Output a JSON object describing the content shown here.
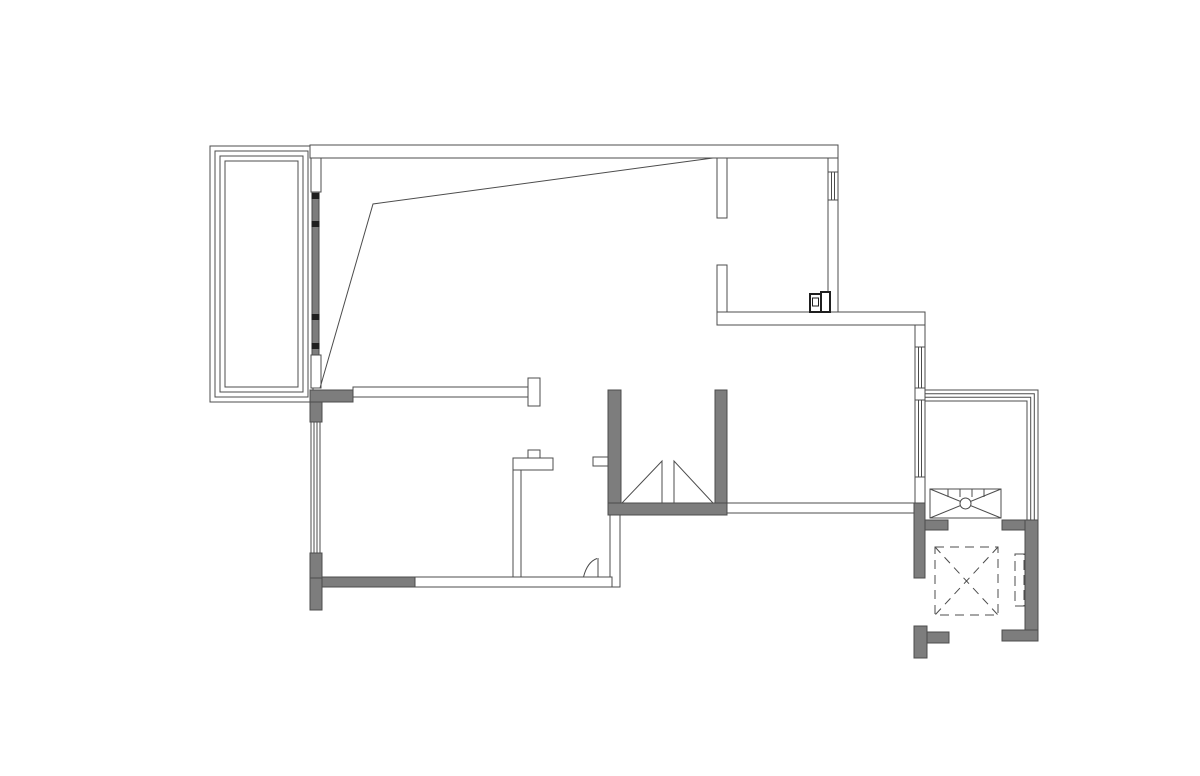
{
  "canvas": {
    "width": 1200,
    "height": 776,
    "background": "#ffffff"
  },
  "palette": {
    "line": "#4c4c4c",
    "wall": "#7d7d7d",
    "mark": "#1f1f1f",
    "white": "#ffffff"
  },
  "floorplan": {
    "description": "apartment-floor-plan-cad-drawing",
    "shapes": [
      {
        "t": "rect",
        "name": "balcony-left-rail-outer",
        "x": 210,
        "y": 146,
        "w": 103,
        "h": 256
      },
      {
        "t": "rect",
        "name": "balcony-left-rail-2",
        "x": 215,
        "y": 151,
        "w": 93,
        "h": 246
      },
      {
        "t": "rect",
        "name": "balcony-left-rail-3",
        "x": 220,
        "y": 156,
        "w": 83,
        "h": 236
      },
      {
        "t": "rect",
        "name": "balcony-left-rail-inner",
        "x": 225,
        "y": 161,
        "w": 73,
        "h": 226
      },
      {
        "t": "rect",
        "name": "wall-top",
        "x": 310,
        "y": 145,
        "w": 528,
        "h": 13,
        "f": "white"
      },
      {
        "t": "rect",
        "name": "wall-balcony-jamb-top",
        "x": 311,
        "y": 158,
        "w": 10,
        "h": 34,
        "f": "white"
      },
      {
        "t": "rect",
        "name": "wall-balcony-jamb-bottom",
        "x": 311,
        "y": 355,
        "w": 10,
        "h": 33,
        "f": "white"
      },
      {
        "t": "rect",
        "name": "wall-east-upper",
        "x": 828,
        "y": 158,
        "w": 10,
        "h": 154,
        "f": "white"
      },
      {
        "t": "rect",
        "name": "window-east-upper",
        "x": 828,
        "y": 172,
        "w": 10,
        "h": 28,
        "f": "white"
      },
      {
        "t": "line",
        "name": "window-east-upper-mullion-1",
        "x1": 831.3,
        "y1": 172,
        "x2": 831.3,
        "y2": 200
      },
      {
        "t": "line",
        "name": "window-east-upper-mullion-2",
        "x1": 834.6,
        "y1": 172,
        "x2": 834.6,
        "y2": 200
      },
      {
        "t": "rect",
        "name": "wall-stub-upper-1",
        "x": 717,
        "y": 158,
        "w": 10,
        "h": 60,
        "f": "white"
      },
      {
        "t": "rect",
        "name": "wall-stub-upper-2",
        "x": 717,
        "y": 265,
        "w": 10,
        "h": 47,
        "f": "white"
      },
      {
        "t": "rect",
        "name": "wall-mid-horizontal",
        "x": 717,
        "y": 312,
        "w": 208,
        "h": 13,
        "f": "white"
      },
      {
        "t": "rect",
        "name": "wall-east-mid-1",
        "x": 915,
        "y": 325,
        "w": 10,
        "h": 22,
        "f": "white"
      },
      {
        "t": "rect",
        "name": "window-east-1",
        "x": 915,
        "y": 347,
        "w": 10,
        "h": 41,
        "f": "white"
      },
      {
        "t": "line",
        "name": "window-east-1-mullion-1",
        "x1": 918.3,
        "y1": 347,
        "x2": 918.3,
        "y2": 388
      },
      {
        "t": "line",
        "name": "window-east-1-mullion-2",
        "x1": 921.6,
        "y1": 347,
        "x2": 921.6,
        "y2": 388
      },
      {
        "t": "rect",
        "name": "wall-east-mid-2",
        "x": 915,
        "y": 388,
        "w": 10,
        "h": 12,
        "f": "white"
      },
      {
        "t": "rect",
        "name": "window-east-2",
        "x": 915,
        "y": 400,
        "w": 10,
        "h": 77,
        "f": "white"
      },
      {
        "t": "line",
        "name": "window-east-2-mullion-1",
        "x1": 918.3,
        "y1": 400,
        "x2": 918.3,
        "y2": 477
      },
      {
        "t": "line",
        "name": "window-east-2-mullion-2",
        "x1": 921.6,
        "y1": 400,
        "x2": 921.6,
        "y2": 477
      },
      {
        "t": "rect",
        "name": "wall-east-mid-3",
        "x": 915,
        "y": 477,
        "w": 10,
        "h": 26,
        "f": "white"
      },
      {
        "t": "rect",
        "name": "wall-dining-south",
        "x": 727,
        "y": 503,
        "w": 188,
        "h": 10,
        "f": "white"
      },
      {
        "t": "rect",
        "name": "wall-divider-A",
        "x": 353,
        "y": 387,
        "w": 175,
        "h": 10,
        "f": "white"
      },
      {
        "t": "rect",
        "name": "wall-divider-A-endcap",
        "x": 528,
        "y": 378,
        "w": 12,
        "h": 28,
        "f": "white"
      },
      {
        "t": "rect",
        "name": "wall-divider-B-vertical",
        "x": 513,
        "y": 458,
        "w": 8,
        "h": 119,
        "f": "white"
      },
      {
        "t": "rect",
        "name": "wall-divider-B-top",
        "x": 513,
        "y": 458,
        "w": 40,
        "h": 12,
        "f": "white"
      },
      {
        "t": "rect",
        "name": "wall-divider-B-post",
        "x": 528,
        "y": 450,
        "w": 12,
        "h": 8,
        "f": "white"
      },
      {
        "t": "rect",
        "name": "wall-stub-at-shaft",
        "x": 593,
        "y": 457,
        "w": 17,
        "h": 9,
        "f": "white"
      },
      {
        "t": "rect",
        "name": "wall-below-shaft",
        "x": 610,
        "y": 515,
        "w": 10,
        "h": 72,
        "f": "white"
      },
      {
        "t": "rect",
        "name": "wall-kitchen-south-thin",
        "x": 415,
        "y": 577,
        "w": 197,
        "h": 10,
        "f": "white"
      },
      {
        "t": "rect",
        "name": "window-kitchen-west",
        "x": 311,
        "y": 422,
        "w": 9,
        "h": 131,
        "f": "white"
      },
      {
        "t": "line",
        "name": "window-kitchen-west-mullion-1",
        "x1": 314,
        "y1": 422,
        "x2": 314,
        "y2": 553
      },
      {
        "t": "line",
        "name": "window-kitchen-west-mullion-2",
        "x1": 317,
        "y1": 422,
        "x2": 317,
        "y2": 553
      },
      {
        "t": "rect",
        "name": "wall-corner-nw-horizontal",
        "x": 310,
        "y": 390,
        "w": 43,
        "h": 12,
        "f": "wall"
      },
      {
        "t": "rect",
        "name": "wall-corner-nw-vertical",
        "x": 310,
        "y": 402,
        "w": 12,
        "h": 20,
        "f": "wall"
      },
      {
        "t": "rect",
        "name": "wall-kitchen-west-lower",
        "x": 310,
        "y": 553,
        "w": 12,
        "h": 25,
        "f": "wall"
      },
      {
        "t": "rect",
        "name": "wall-kitchen-west-tail",
        "x": 310,
        "y": 578,
        "w": 12,
        "h": 32,
        "f": "wall"
      },
      {
        "t": "rect",
        "name": "wall-kitchen-south-gray",
        "x": 322,
        "y": 577,
        "w": 93,
        "h": 10,
        "f": "wall"
      },
      {
        "t": "rect",
        "name": "shaft-wall-west",
        "x": 608,
        "y": 390,
        "w": 13,
        "h": 113,
        "f": "wall"
      },
      {
        "t": "rect",
        "name": "shaft-wall-east",
        "x": 715,
        "y": 390,
        "w": 12,
        "h": 113,
        "f": "wall"
      },
      {
        "t": "rect",
        "name": "shaft-wall-south",
        "x": 608,
        "y": 503,
        "w": 119,
        "h": 12,
        "f": "wall"
      },
      {
        "t": "rect",
        "name": "core-wall-west-upper",
        "x": 914,
        "y": 503,
        "w": 11,
        "h": 75,
        "f": "wall"
      },
      {
        "t": "rect",
        "name": "core-wall-west-lower",
        "x": 914,
        "y": 626,
        "w": 13,
        "h": 32,
        "f": "wall"
      },
      {
        "t": "rect",
        "name": "core-wall-west-lower-h",
        "x": 927,
        "y": 632,
        "w": 22,
        "h": 11,
        "f": "wall"
      },
      {
        "t": "rect",
        "name": "core-wall-north-left",
        "x": 925,
        "y": 520,
        "w": 23,
        "h": 10,
        "f": "wall"
      },
      {
        "t": "rect",
        "name": "core-wall-north-right",
        "x": 1002,
        "y": 520,
        "w": 36,
        "h": 10,
        "f": "wall"
      },
      {
        "t": "rect",
        "name": "core-wall-east",
        "x": 1025,
        "y": 520,
        "w": 13,
        "h": 121,
        "f": "wall"
      },
      {
        "t": "rect",
        "name": "core-wall-south-right",
        "x": 1002,
        "y": 630,
        "w": 36,
        "h": 11,
        "f": "wall"
      },
      {
        "t": "rect",
        "name": "sliding-door-track",
        "x": 312,
        "y": 192,
        "w": 7,
        "h": 163,
        "f": "wall"
      },
      {
        "t": "rect",
        "name": "sliding-door-roller-1",
        "x": 311.5,
        "y": 193,
        "w": 8,
        "h": 6,
        "f": "mark",
        "sw": 0
      },
      {
        "t": "rect",
        "name": "sliding-door-roller-2",
        "x": 311.5,
        "y": 221,
        "w": 8,
        "h": 6,
        "f": "mark",
        "sw": 0
      },
      {
        "t": "rect",
        "name": "sliding-door-roller-3",
        "x": 311.5,
        "y": 314,
        "w": 8,
        "h": 6,
        "f": "mark",
        "sw": 0
      },
      {
        "t": "rect",
        "name": "sliding-door-roller-4",
        "x": 311.5,
        "y": 343,
        "w": 8,
        "h": 6,
        "f": "mark",
        "sw": 0
      },
      {
        "t": "polygon",
        "name": "shaft-triangle-left",
        "pts": "622,503 662,461 662,503"
      },
      {
        "t": "polygon",
        "name": "shaft-triangle-right",
        "pts": "674,461 674,503 713,503"
      },
      {
        "t": "path",
        "name": "balcony-right-rail-outer",
        "d": "M925,390 H1038 V520"
      },
      {
        "t": "path",
        "name": "balcony-right-rail-2",
        "d": "M925,393.7 H1034.3 V520"
      },
      {
        "t": "path",
        "name": "balcony-right-rail-3",
        "d": "M925,397.3 H1030.7 V520"
      },
      {
        "t": "path",
        "name": "balcony-right-rail-inner",
        "d": "M925,401 H1027 V520"
      },
      {
        "t": "rect",
        "name": "radiator-body",
        "x": 930,
        "y": 489,
        "w": 71,
        "h": 29,
        "f": "white"
      },
      {
        "t": "line",
        "name": "radiator-diagonal-1",
        "x1": 930,
        "y1": 489,
        "x2": 1001,
        "y2": 518
      },
      {
        "t": "line",
        "name": "radiator-diagonal-2",
        "x1": 930,
        "y1": 518,
        "x2": 1001,
        "y2": 489
      },
      {
        "t": "circle",
        "name": "radiator-hub",
        "cx": 965.5,
        "cy": 503.5,
        "r": 5.5,
        "f": "white"
      },
      {
        "t": "line",
        "name": "radiator-tick-1",
        "x1": 948,
        "y1": 489,
        "x2": 948,
        "y2": 497
      },
      {
        "t": "line",
        "name": "radiator-tick-2",
        "x1": 960,
        "y1": 489,
        "x2": 960,
        "y2": 497
      },
      {
        "t": "line",
        "name": "radiator-tick-3",
        "x1": 972,
        "y1": 489,
        "x2": 972,
        "y2": 497
      },
      {
        "t": "line",
        "name": "radiator-tick-4",
        "x1": 984,
        "y1": 489,
        "x2": 984,
        "y2": 497
      },
      {
        "t": "rect",
        "name": "elevator-cab",
        "x": 935,
        "y": 547,
        "w": 63,
        "h": 68,
        "dash": "9 6"
      },
      {
        "t": "line",
        "name": "elevator-diagonal-1",
        "x1": 935,
        "y1": 547,
        "x2": 998,
        "y2": 615,
        "dash": "8 6"
      },
      {
        "t": "line",
        "name": "elevator-diagonal-2",
        "x1": 998,
        "y1": 547,
        "x2": 935,
        "y2": 615,
        "dash": "8 6"
      },
      {
        "t": "rect",
        "name": "elevator-door-dashed",
        "x": 1015,
        "y": 554,
        "w": 9,
        "h": 52,
        "dash": "10 5"
      },
      {
        "t": "rect",
        "name": "meter-box-left",
        "x": 810,
        "y": 294,
        "w": 12,
        "h": 18,
        "f": "white",
        "sc": "mark",
        "sw": 2
      },
      {
        "t": "rect",
        "name": "meter-box-right",
        "x": 821,
        "y": 292,
        "w": 9,
        "h": 20,
        "f": "white",
        "sc": "mark",
        "sw": 2
      },
      {
        "t": "rect",
        "name": "meter-box-inner",
        "x": 812.5,
        "y": 298,
        "w": 6,
        "h": 8,
        "sc": "mark",
        "sw": 1.3
      },
      {
        "t": "path",
        "name": "door-swing-arc",
        "d": "M583.5,577 C586,567 590,561 597,558.5"
      },
      {
        "t": "line",
        "name": "door-leaf",
        "x1": 598,
        "y1": 558,
        "x2": 598,
        "y2": 577
      },
      {
        "t": "polyline",
        "name": "ceiling-break-line",
        "pts": "320,388 373,204 713,158"
      }
    ]
  }
}
